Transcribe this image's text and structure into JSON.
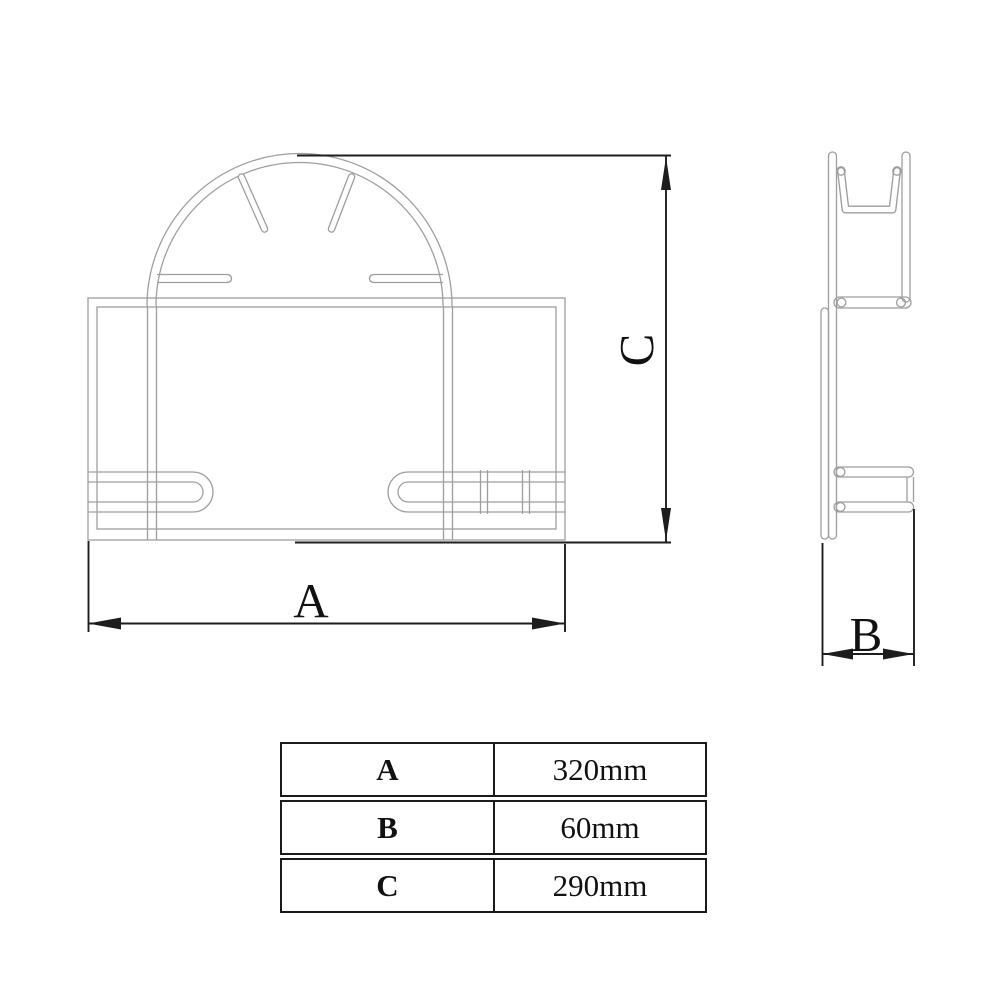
{
  "diagram": {
    "title": "wall-mounted holder technical drawing",
    "labels": {
      "a": "A",
      "b": "B",
      "c": "C"
    },
    "colors": {
      "outline": "#9e9e9e",
      "dimension": "#1d1d1d",
      "background": "#ffffff"
    }
  },
  "table": {
    "rows": [
      {
        "label": "A",
        "value": "320mm"
      },
      {
        "label": "B",
        "value": "60mm"
      },
      {
        "label": "C",
        "value": "290mm"
      }
    ]
  }
}
